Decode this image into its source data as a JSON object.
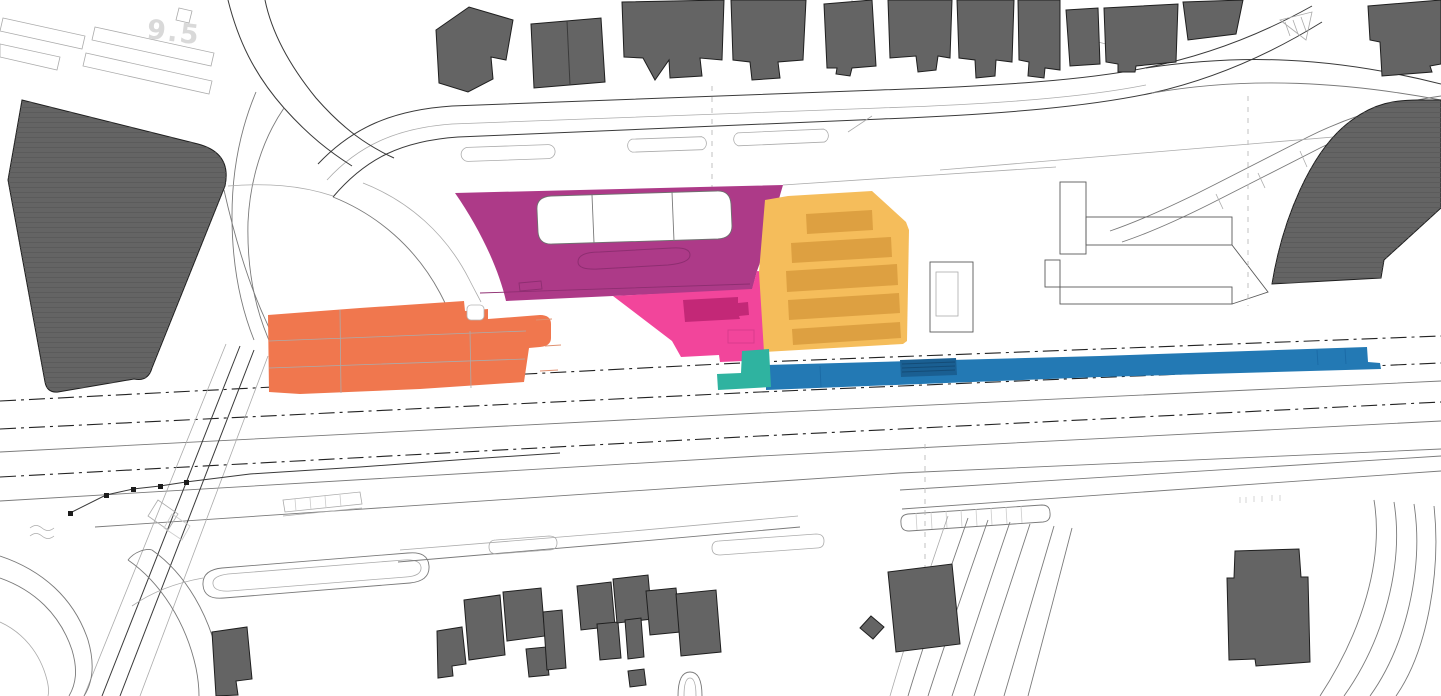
{
  "document": {
    "title": "Station area masterplan site drawing",
    "background": "#ffffff"
  },
  "annotations": {
    "elevation_label": "9.5"
  },
  "palette": {
    "building_fill": "#646464",
    "building_hatch": "#585858",
    "building_stroke": "#1f1f1f",
    "line_strong": "#3a3a3a",
    "line_faint": "#ababab"
  },
  "zones": {
    "magenta": {
      "label": "magenta station building zone",
      "color": "#AD3A88",
      "detail_color": "#8E2E71"
    },
    "pink": {
      "label": "pink forecourt zone",
      "color": "#F2459B",
      "detail_color": "#D93B8D"
    },
    "pink_dark": {
      "label": "dark pink structure",
      "color": "#C32877"
    },
    "orange": {
      "label": "orange development zone",
      "color": "#F0774E",
      "detail_color": "#E09070"
    },
    "amber": {
      "label": "amber parking zone",
      "color": "#F5BD5B"
    },
    "amber_dark": {
      "label": "amber parking row",
      "color": "#DDA041"
    },
    "teal": {
      "label": "teal access link",
      "color": "#2FB3A0"
    },
    "blue": {
      "label": "blue platform zone",
      "color": "#2379B4",
      "seam_color": "#1B6AA5"
    },
    "blue_dark": {
      "label": "platform stair block",
      "color": "#1A5F92",
      "line_color": "#144C77"
    }
  }
}
